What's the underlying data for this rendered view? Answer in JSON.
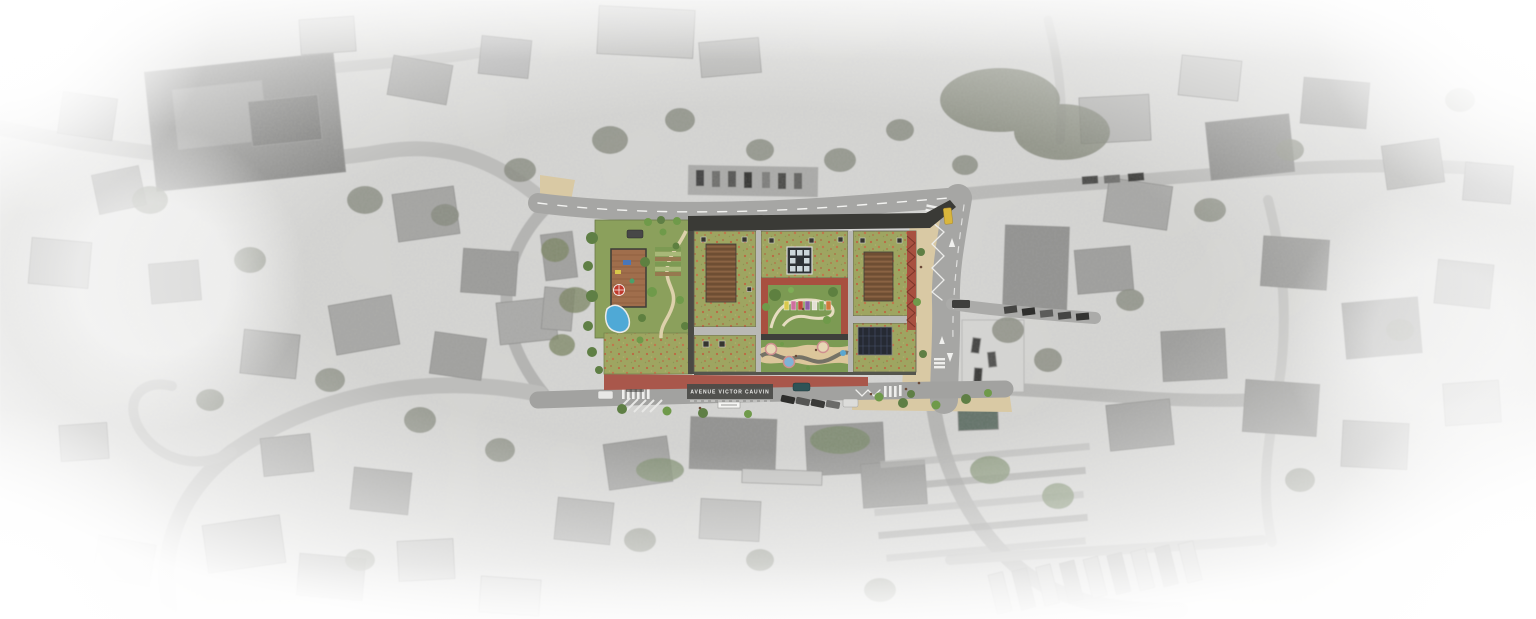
{
  "scene": {
    "description": "Colored landscape masterplan (green roofs, courtyards, playgrounds, pool) overlaid on a desaturated aerial photograph that fades to white at the edges",
    "street_label": "AVENUE VICTOR CAUVIN"
  },
  "colors": {
    "meadow_green": "#9ea561",
    "poppy_red": "#c25c3e",
    "courtyard_green": "#7c9a53",
    "sand_beige": "#d9c9a4",
    "playground_sand": "#dcc69b",
    "red_paving": "#a9574b",
    "red_frame": "#a85040",
    "canopy_dark": "#3a3a36",
    "pergola_brown": "#7a573a",
    "pool_blue": "#4fa9d6",
    "solar_dark": "#262a33",
    "taxi_yellow": "#d9b63c",
    "road_gray": "#a6a6a4",
    "plate_gray": "#4a4a46",
    "tree_green": "#5f7f45",
    "aerial_base": "#d6d6d4"
  }
}
